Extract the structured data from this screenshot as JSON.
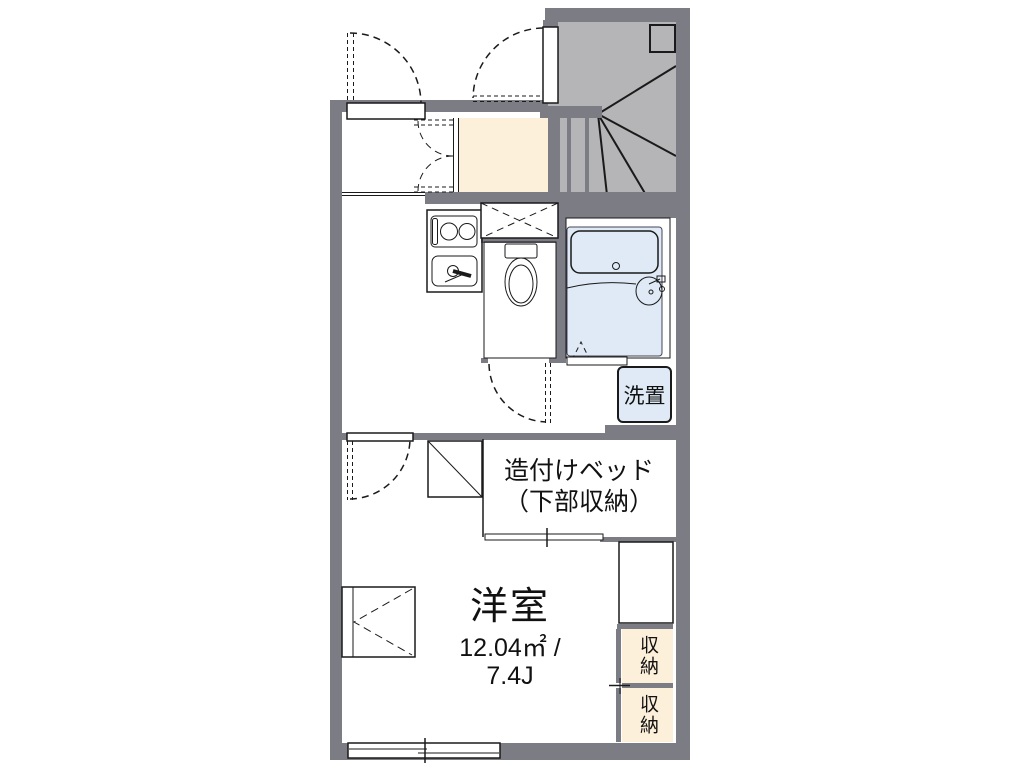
{
  "floorplan": {
    "rooms": {
      "western_room": {
        "name": "洋室",
        "area": "12.04㎡ /",
        "tatami": "7.4J"
      },
      "built_in_bed": {
        "name": "造付けベッド",
        "sub": "（下部収納）"
      },
      "washing_machine": {
        "label": "洗置"
      },
      "storage_top": {
        "label": "収納"
      },
      "storage_bottom": {
        "label": "収納"
      }
    },
    "colors": {
      "wall": "#7c7c84",
      "stair": "#b5b5b7",
      "water": "#dbe7f5",
      "bath": "#dfeaf6",
      "kitchen": "#d7e3f2",
      "cream": "#fcf0da",
      "line": "#1a1a1a"
    }
  }
}
